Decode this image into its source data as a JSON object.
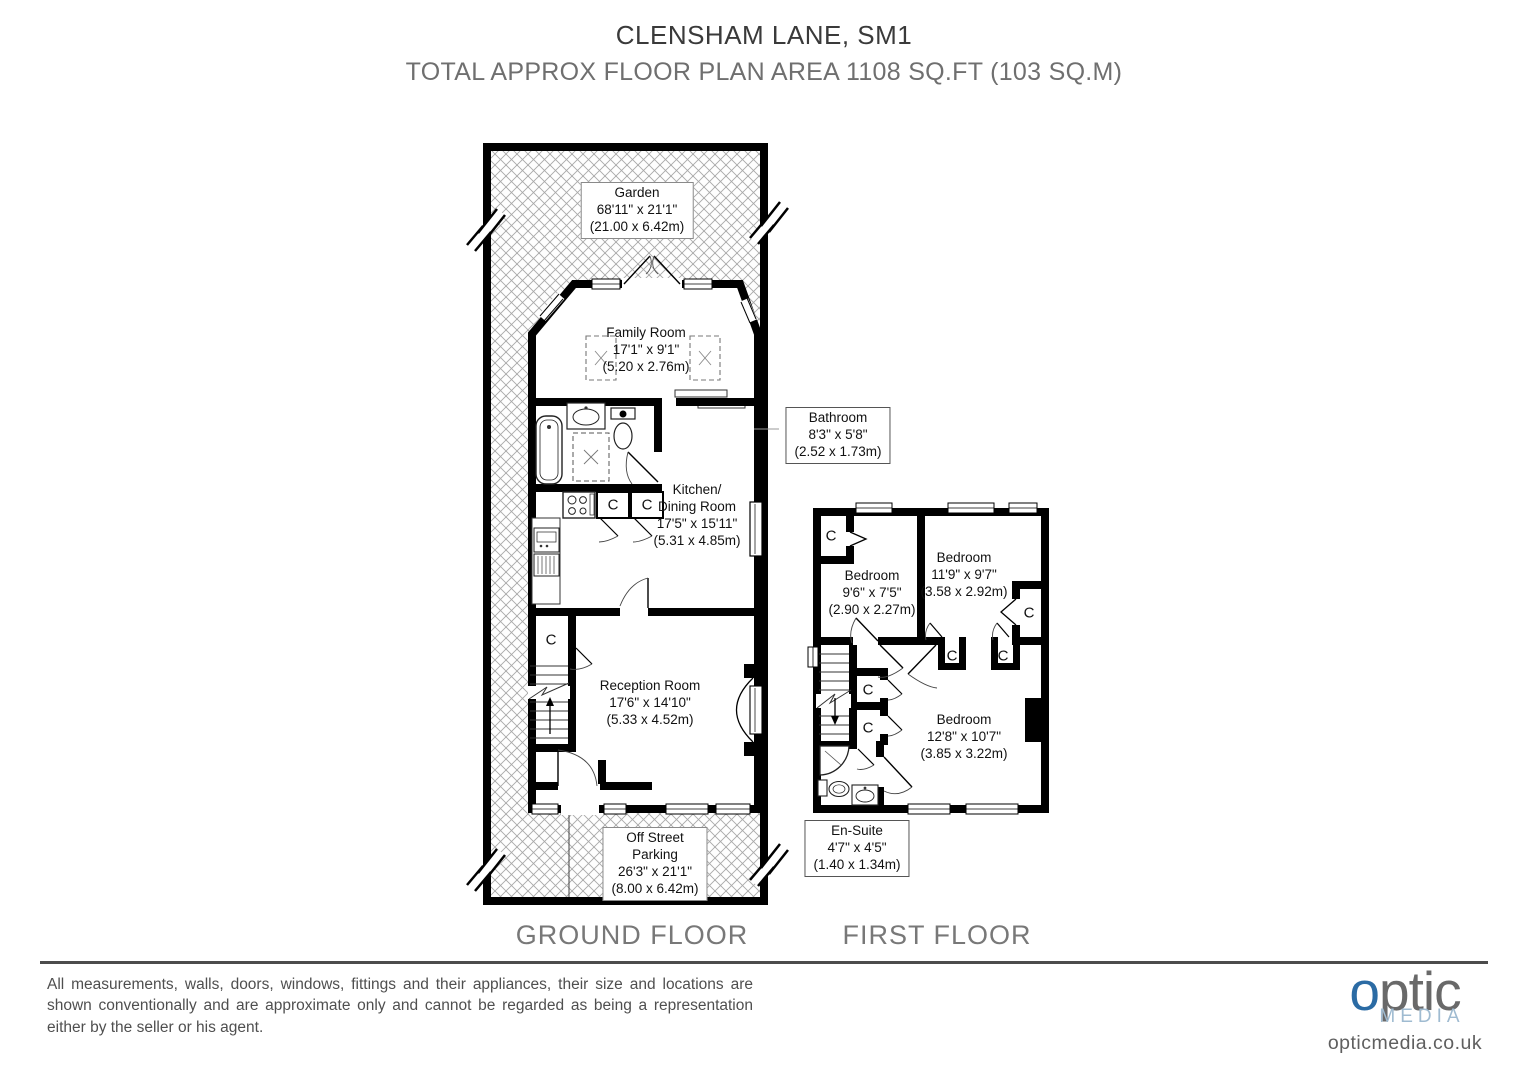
{
  "header": {
    "title": "CLENSHAM LANE, SM1",
    "subtitle": "TOTAL APPROX FLOOR PLAN AREA 1108 SQ.FT (103 SQ.M)"
  },
  "plan": {
    "closet_label": "C"
  },
  "ground_floor": {
    "caption": "GROUND FLOOR",
    "garden": {
      "name": "Garden",
      "imperial": "68'11\" x 21'1\"",
      "metric": "(21.00 x 6.42m)"
    },
    "family_room": {
      "name": "Family Room",
      "imperial": "17'1\" x 9'1\"",
      "metric": "(5.20 x 2.76m)"
    },
    "bathroom": {
      "name": "Bathroom",
      "imperial": "8'3\" x 5'8\"",
      "metric": "(2.52 x 1.73m)"
    },
    "kitchen_dining": {
      "name_line1": "Kitchen/",
      "name_line2": "Dining Room",
      "imperial": "17'5\" x 15'11\"",
      "metric": "(5.31 x 4.85m)"
    },
    "reception": {
      "name": "Reception Room",
      "imperial": "17'6\" x 14'10\"",
      "metric": "(5.33 x 4.52m)"
    },
    "parking": {
      "name_line1": "Off Street",
      "name_line2": "Parking",
      "imperial": "26'3\" x 21'1\"",
      "metric": "(8.00 x 6.42m)"
    }
  },
  "first_floor": {
    "caption": "FIRST FLOOR",
    "bedroom_small": {
      "name": "Bedroom",
      "imperial": "9'6\" x 7'5\"",
      "metric": "(2.90 x 2.27m)"
    },
    "bedroom_mid": {
      "name": "Bedroom",
      "imperial": "11'9\" x 9'7\"",
      "metric": "(3.58 x 2.92m)"
    },
    "bedroom_large": {
      "name": "Bedroom",
      "imperial": "12'8\" x 10'7\"",
      "metric": "(3.85 x 3.22m)"
    },
    "ensuite": {
      "name": "En-Suite",
      "imperial": "4'7\" x 4'5\"",
      "metric": "(1.40 x 1.34m)"
    }
  },
  "footer": {
    "disclaimer": "All measurements, walls, doors, windows, fittings and their appliances, their size and locations are shown conventionally and are approximate only and cannot be regarded as being a representation either by the seller or his agent.",
    "logo": {
      "brand_first": "o",
      "brand_rest": "ptic",
      "brand_sub": "MEDIA",
      "website": "opticmedia.co.uk"
    }
  },
  "colors": {
    "wall": "#000000",
    "hatch": "#a8a8a8",
    "title_text": "#3a3a3a",
    "gray_text": "#6f6f6f",
    "logo_blue": "#2b6ba4",
    "logo_gray": "#696969",
    "logo_lightblue": "#9fbbd1"
  }
}
